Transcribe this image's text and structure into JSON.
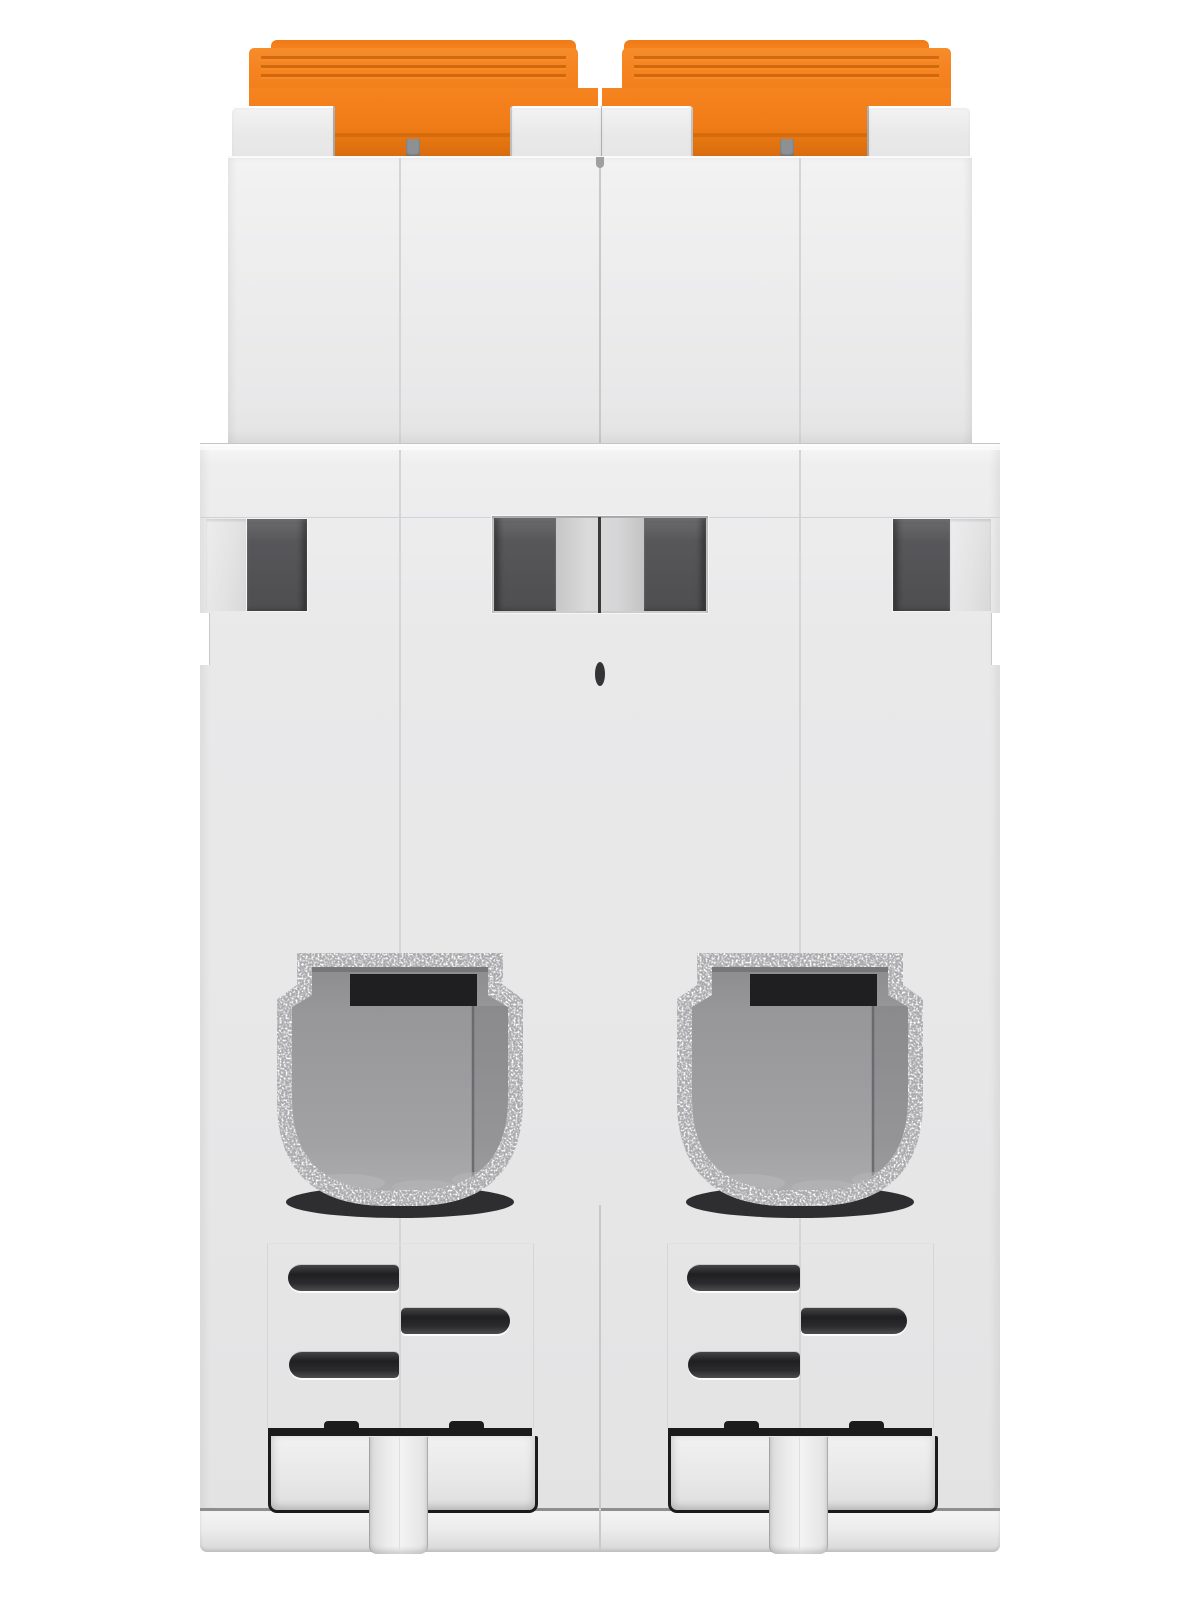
{
  "product": {
    "name": "Two-pole DIN-rail miniature circuit breaker, rear/bottom view",
    "poles": 2,
    "visible_text": ""
  },
  "palette": {
    "background": "#FFFFFF",
    "handle_orange": "#F5831F",
    "handle_orange_dark": "#D96B0E",
    "handle_ridge": "#C45F08",
    "body_light": "#F1F1F2",
    "body_mid": "#E9E9EA",
    "body_shadow": "#DFDFE0",
    "edge_line": "#C7C7C8",
    "slot_dark": "#57575A",
    "vent_dark": "#1F1F21",
    "terminal_metal": "#C9C9CA",
    "terminal_cavity": "#98989A",
    "terminal_strip": "#1F1F21",
    "outline_dark": "#1B1B1C"
  },
  "components": {
    "toggle_handles": "two serrated orange switch toggles protruding at top",
    "grip_ridges": "three molded grip grooves on each toggle cap",
    "housing_tabs": "four raised housing tabs framing the toggle slots",
    "latch_slots": "four dark rectangular latch openings across upper band",
    "terminal_openings": "two metallic-rimmed screw terminal cavities",
    "vent_slots": "three staggered ventilation slots per pole",
    "din_blocks": "dark-outlined DIN clip blocks at bottom",
    "din_feet": "two spring clip feet protruding below the housing"
  }
}
